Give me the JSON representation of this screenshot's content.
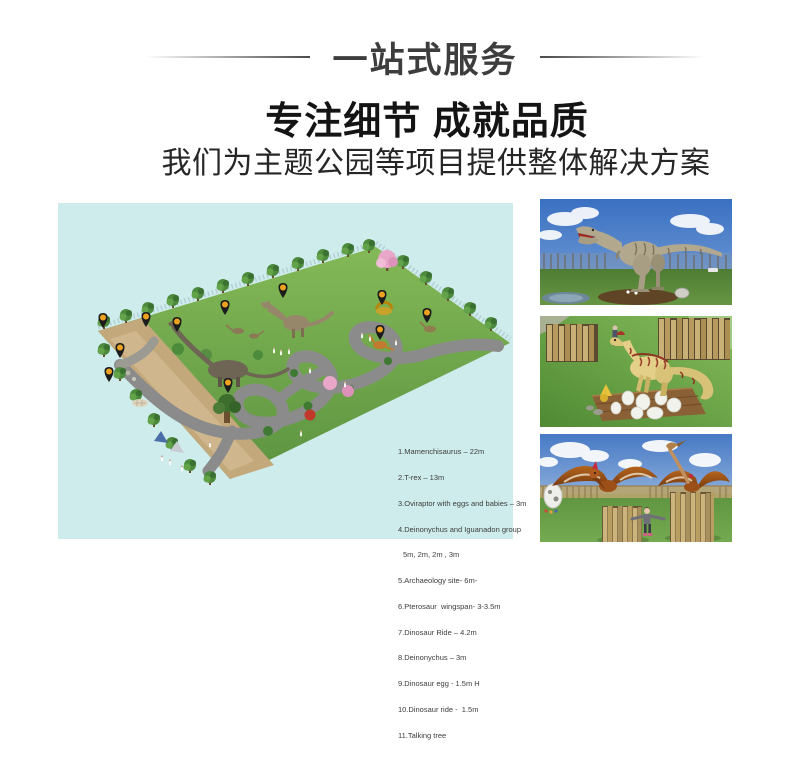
{
  "header": {
    "banner_title": "一站式服务",
    "headline": "专注细节 成就品质",
    "subtitle": "我们为主题公园等项目提供整体解决方案"
  },
  "park_map": {
    "background_color": "#cfecec",
    "pin_color": "#1c1c1c",
    "pin_dot_color": "#eda21f",
    "pin_count": 11,
    "legend_items": [
      "1.Mamenchisaurus – 22m",
      "2.T-rex – 13m",
      "3.Oviraptor with eggs and babies – 3m",
      "4.Deinonychus and Iguanadon group",
      "5m, 2m, 2m , 3m",
      "5.Archaeology site- 6m-",
      "6.Pterosaur  wingspan- 3-3.5m",
      "7.Dinosaur Ride – 4.2m",
      "8.Deinonychus – 3m",
      "9.Dinosaur egg - 1.5m H",
      "10.Dinosaur ride -  1.5m",
      "11.Talking tree"
    ]
  },
  "photos": [
    {
      "label": "tyrannosaurus-model"
    },
    {
      "label": "oviraptor-with-eggs-model"
    },
    {
      "label": "pterosaur-models"
    }
  ]
}
